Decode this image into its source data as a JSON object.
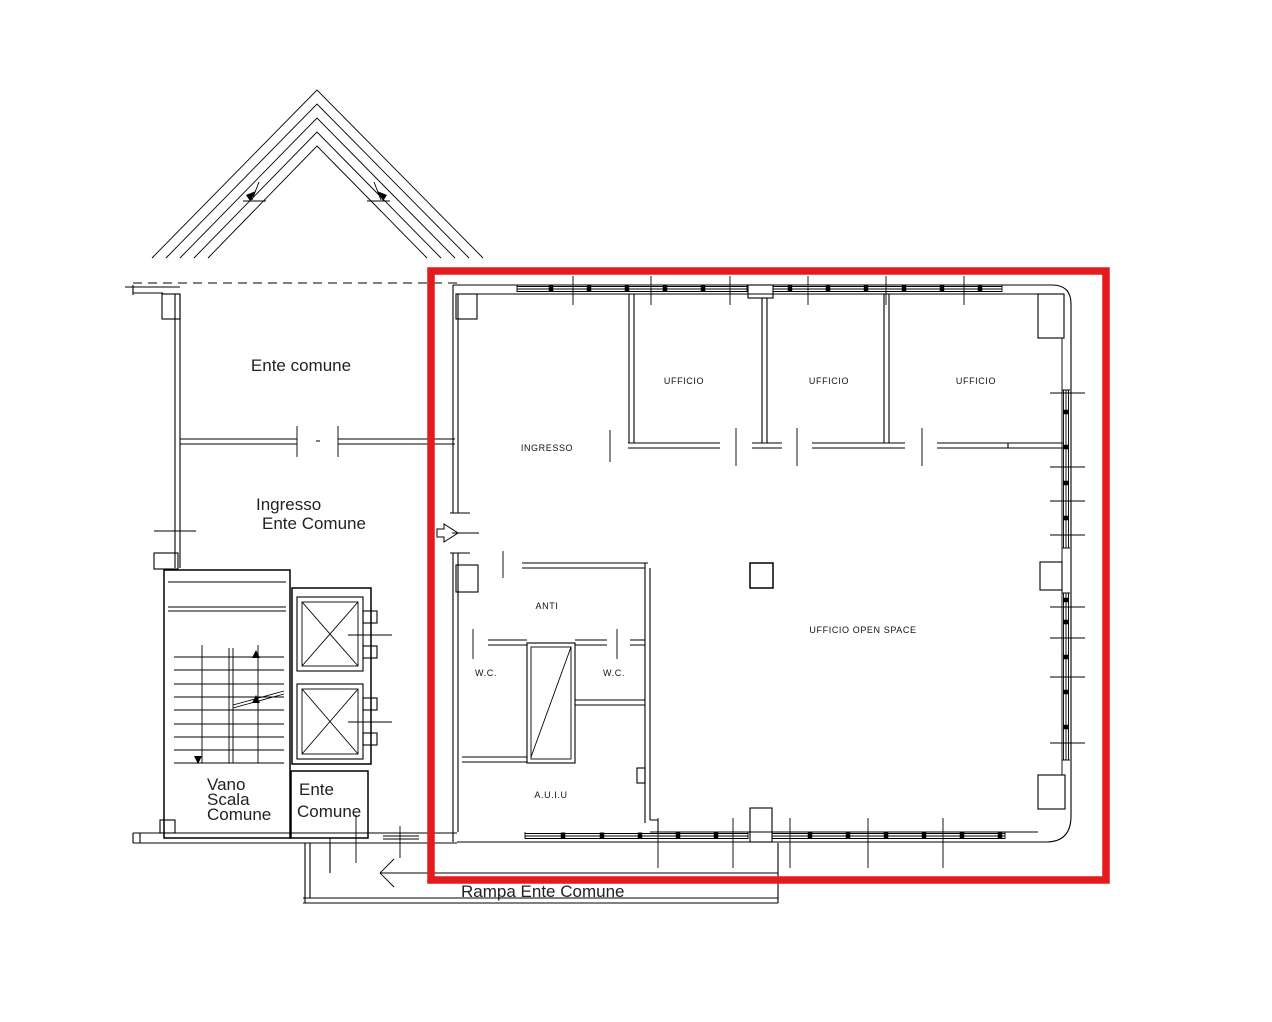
{
  "colors": {
    "highlight_red": "#e51a1c",
    "line_black": "#000000",
    "background": "#ffffff"
  },
  "left_wing": {
    "room_upper_label": "Ente comune",
    "room_lower_label_line1": "Ingresso",
    "room_lower_label_line2": "Ente Comune",
    "stairwell_label_line1": "Vano",
    "stairwell_label_line2": "Scala",
    "stairwell_label_line3": "Comune",
    "small_room_label_line1": "Ente",
    "small_room_label_line2": "Comune"
  },
  "highlighted_unit": {
    "entrance_label": "INGRESSO",
    "office1_label": "UFFICIO",
    "office2_label": "UFFICIO",
    "office3_label": "UFFICIO",
    "anteroom_label": "ANTI",
    "wc_left_label": "W.C.",
    "wc_right_label": "W.C.",
    "auiu_label": "A.U.I.U",
    "open_space_label": "UFFICIO OPEN SPACE"
  },
  "ramp": {
    "label": "Rampa Ente Comune"
  }
}
